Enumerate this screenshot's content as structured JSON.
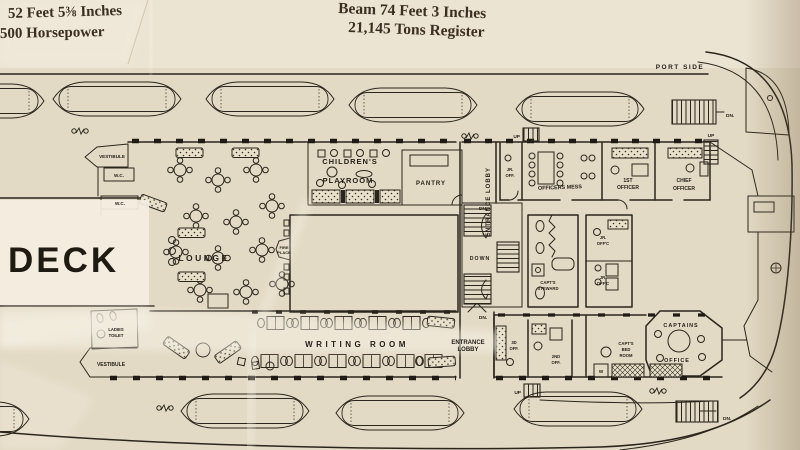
{
  "header": {
    "length": "52 Feet 5⅜ Inches",
    "power": "500 Horsepower",
    "beam": "Beam 74 Feet 3 Inches",
    "tonnage": "21,145 Tons Register"
  },
  "plan": {
    "deck_name": "DECK",
    "side": "PORT SIDE",
    "lounge": "LOUNGE",
    "childrens_1": "CHILDREN'S",
    "childrens_2": "PLAYROOM",
    "pantry": "PANTRY",
    "entrance_lobby_v": "ENTRANCE LOBBY",
    "entrance_1": "ENTRANCE",
    "entrance_2": "LOBBY",
    "writing_room": "WRITING ROOM",
    "vestibule": "VESTIBULE",
    "wc": "W.C.",
    "ladies_1": "LADIES",
    "ladies_2": "TOILET",
    "fire_1": "FIRE",
    "fire_2": "PLACE",
    "officers_mess": "OFFICERS MESS",
    "jr": "JR.",
    "off_abbrev": "OFF.",
    "offc_abbrev": "OFF'C",
    "first": "1ST",
    "chief": "CHIEF",
    "officer": "OFFICER",
    "steward_1": "CAPT'S",
    "steward_2": "STEWARD",
    "third": "3D",
    "second": "2ND",
    "capt_bed_1": "CAPT'S",
    "capt_bed_2": "BED",
    "capt_bed_3": "ROOM",
    "captains": "CAPTAINS",
    "office": "OFFICE",
    "wardrobe": "W",
    "down": "DOWN",
    "dn": "DN.",
    "up": "UP"
  }
}
